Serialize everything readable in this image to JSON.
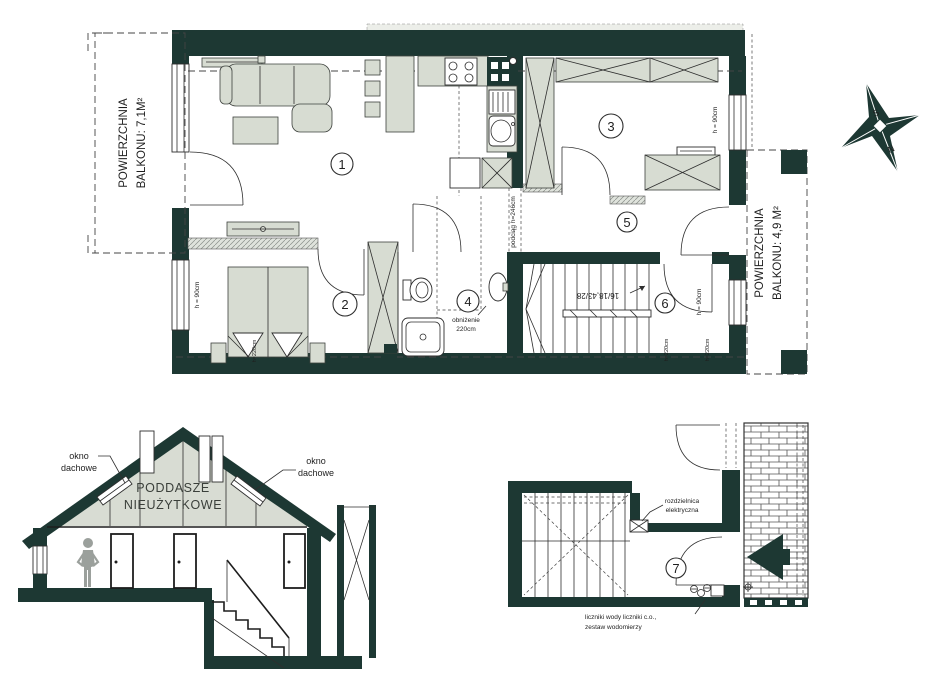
{
  "colors": {
    "wall": "#1d3833",
    "furn": "#d7dcd2"
  },
  "plan": {
    "balcony_left": {
      "line1": "POWIERZCHNIA",
      "line2": "BALKONU: 7,1M²"
    },
    "balcony_right": {
      "line1": "POWIERZCHNIA",
      "line2": "BALKONU: 4,9 M²"
    },
    "rooms": {
      "r1": "1",
      "r2": "2",
      "r3": "3",
      "r4": "4",
      "r5": "5",
      "r6": "6",
      "r7": "7"
    },
    "annotations": {
      "sill_height": "h = 90cm",
      "lintel_height": "h=220cm",
      "beam": "podciąg h=246cm",
      "ceiling_drop_line1": "obniżenie",
      "ceiling_drop_line2": "220cm",
      "stair_dimensions": "16/18,43/28",
      "switchboard_line1": "rozdzielnica",
      "switchboard_line2": "elektryczna",
      "meters_line1": "liczniki wody liczniki c.o.,",
      "meters_line2": "zestaw wodomierzy"
    }
  },
  "section": {
    "attic_line1": "PODDASZE",
    "attic_line2": "NIEUŻYTKOWE",
    "roof_window_line1": "okno",
    "roof_window_line2": "dachowe"
  },
  "compass": {
    "south": "S",
    "north": "N"
  }
}
